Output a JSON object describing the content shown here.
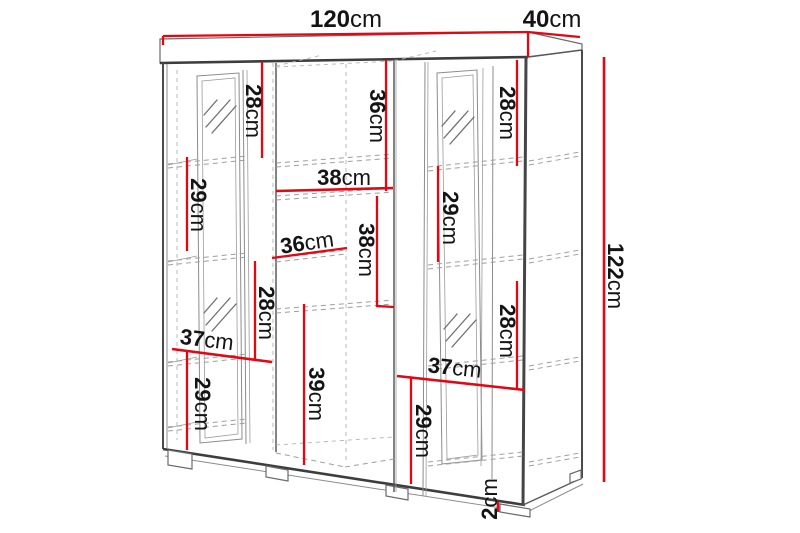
{
  "colors": {
    "dimension_line": "#e30613",
    "outline": "#4a4a4a"
  },
  "dimensions": {
    "top_width": {
      "value": "120",
      "unit": "cm"
    },
    "top_depth": {
      "value": "40",
      "unit": "cm"
    },
    "overall_height": {
      "value": "122",
      "unit": "cm"
    },
    "left_top_height": {
      "value": "28",
      "unit": "cm"
    },
    "middle_top_height": {
      "value": "36",
      "unit": "cm"
    },
    "right_top_height": {
      "value": "28",
      "unit": "cm"
    },
    "left_second_height": {
      "value": "29",
      "unit": "cm"
    },
    "right_second_height": {
      "value": "29",
      "unit": "cm"
    },
    "middle_width": {
      "value": "38",
      "unit": "cm"
    },
    "middle_section_height": {
      "value": "38",
      "unit": "cm"
    },
    "shelf_depth": {
      "value": "36",
      "unit": "cm"
    },
    "left_third_height": {
      "value": "28",
      "unit": "cm"
    },
    "right_third_height": {
      "value": "28",
      "unit": "cm"
    },
    "left_width": {
      "value": "37",
      "unit": "cm"
    },
    "right_width": {
      "value": "37",
      "unit": "cm"
    },
    "left_bottom_height": {
      "value": "29",
      "unit": "cm"
    },
    "middle_bottom_height": {
      "value": "39",
      "unit": "cm"
    },
    "right_bottom_height": {
      "value": "29",
      "unit": "cm"
    },
    "foot_height": {
      "value": "2",
      "unit": "cm"
    }
  }
}
